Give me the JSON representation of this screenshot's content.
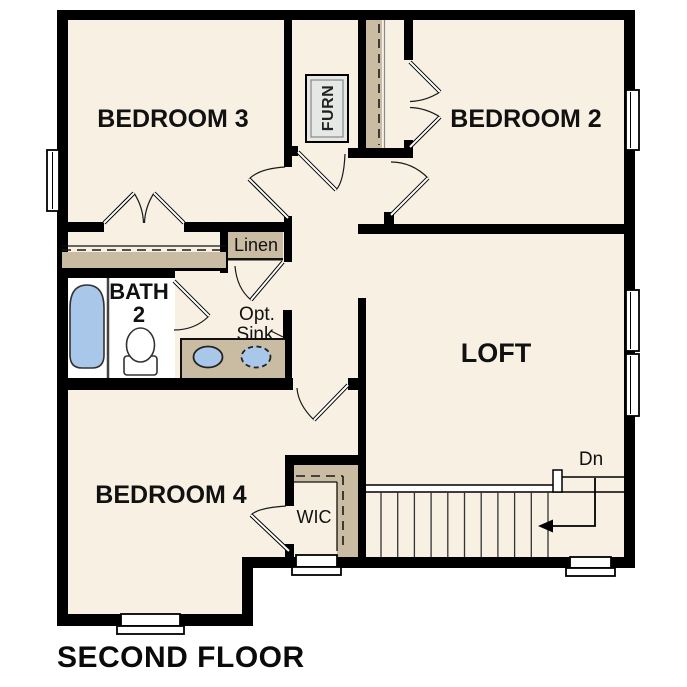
{
  "title": "SECOND FLOOR",
  "colors": {
    "floor": "#f7f0e3",
    "wall": "#000000",
    "casework": "#cabca2",
    "fixture_blue": "#a9c7e8",
    "equipment_gray": "#e6e8e5",
    "paper": "#ffffff"
  },
  "rooms": {
    "bedroom3": {
      "label": "BEDROOM 3"
    },
    "bedroom2": {
      "label": "BEDROOM 2"
    },
    "bedroom4": {
      "label": "BEDROOM 4"
    },
    "loft": {
      "label": "LOFT"
    },
    "bath2": {
      "label_line1": "BATH",
      "label_line2": "2"
    },
    "wic": {
      "label": "WIC"
    },
    "linen": {
      "label": "Linen"
    },
    "furnace": {
      "label": "FURN"
    },
    "opt_sink": {
      "label_line1": "Opt.",
      "label_line2": "Sink"
    },
    "stairs": {
      "direction_label": "Dn"
    }
  }
}
